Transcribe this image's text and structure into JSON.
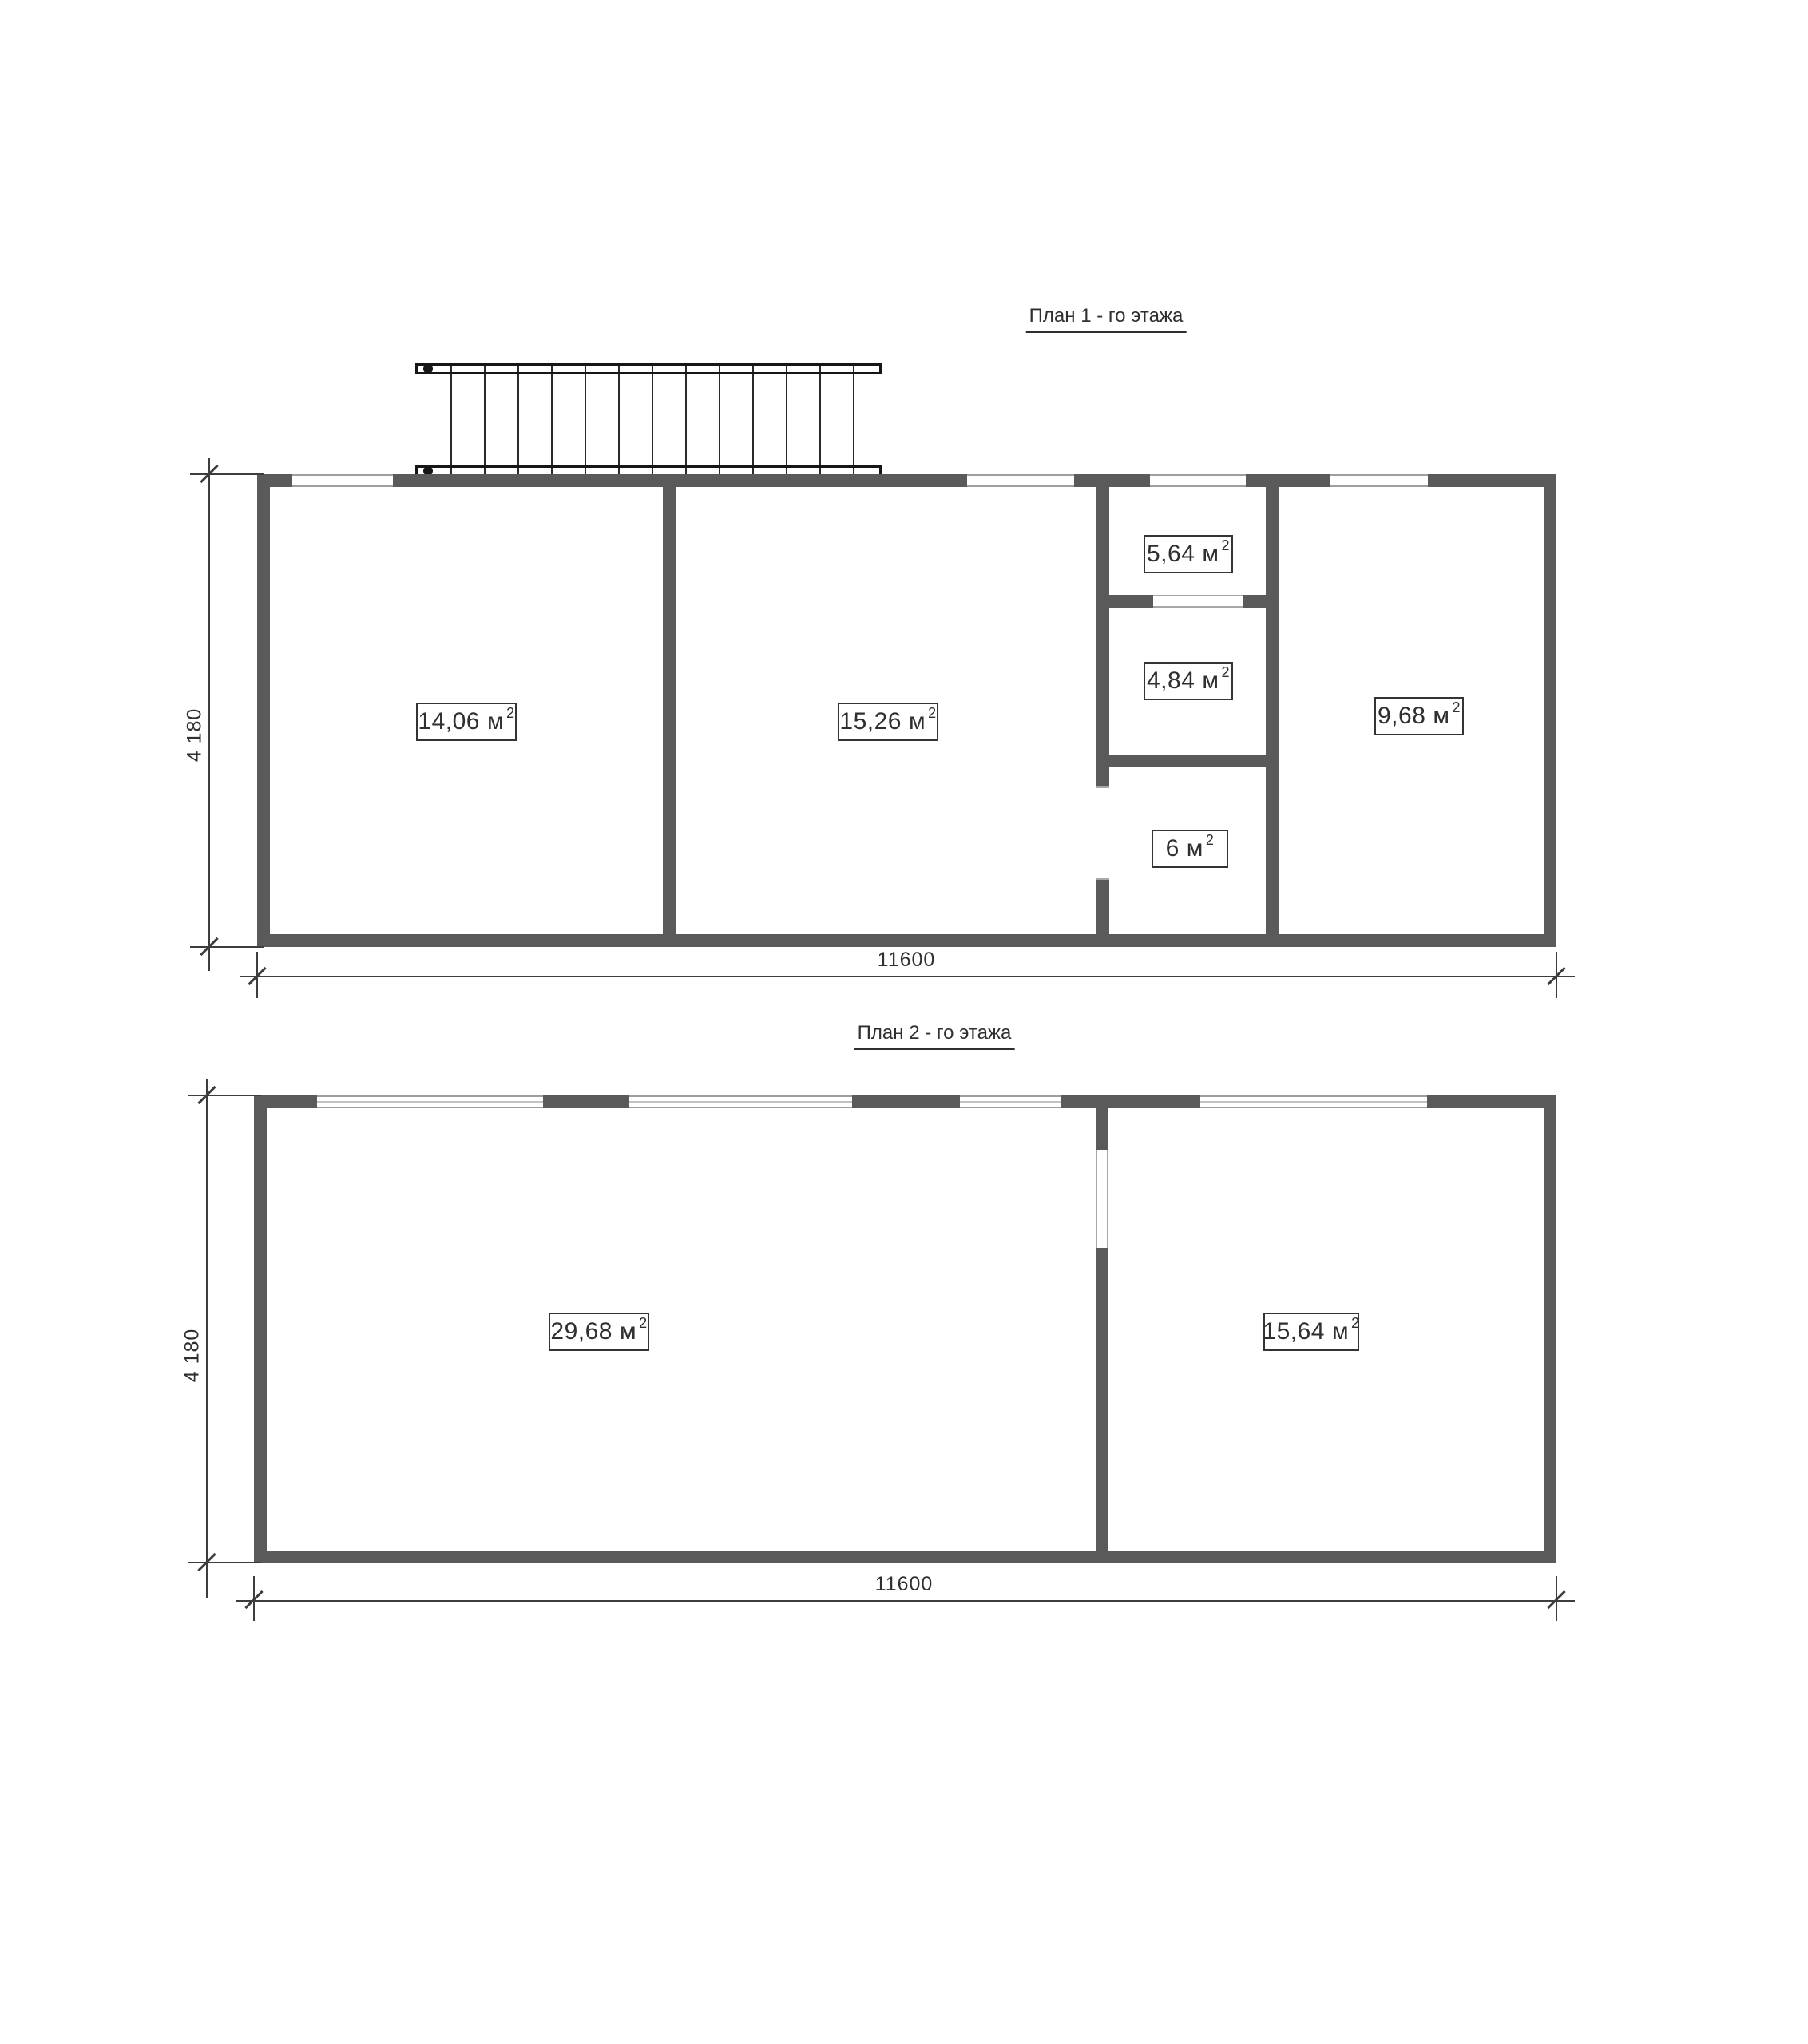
{
  "document": {
    "type": "architectural floor plan drawing",
    "background": "#ffffff"
  },
  "colors": {
    "wall": "#5a5a5a",
    "stair_outline": "#161616",
    "dimension_line": "#3d3d3d",
    "window_line": "#9f9f9f",
    "text": "#2f2f2f"
  },
  "units": {
    "area_unit": "м",
    "area_exponent": "2"
  },
  "plan1": {
    "title": "План 1 - го этажа",
    "dim_width": "11600",
    "dim_height": "4 180",
    "stairs": {
      "tread_count": 13
    },
    "rooms": [
      {
        "name": "room-1",
        "area": "14,06"
      },
      {
        "name": "room-2",
        "area": "15,26"
      },
      {
        "name": "room-3",
        "area": "5,64"
      },
      {
        "name": "room-4",
        "area": "4,84"
      },
      {
        "name": "room-5",
        "area": "6"
      },
      {
        "name": "room-6",
        "area": "9,68"
      }
    ]
  },
  "plan2": {
    "title": "План 2 - го этажа",
    "dim_width": "11600",
    "dim_height": "4 180",
    "rooms": [
      {
        "name": "room-1",
        "area": "29,68"
      },
      {
        "name": "room-2",
        "area": "15,64"
      }
    ]
  }
}
